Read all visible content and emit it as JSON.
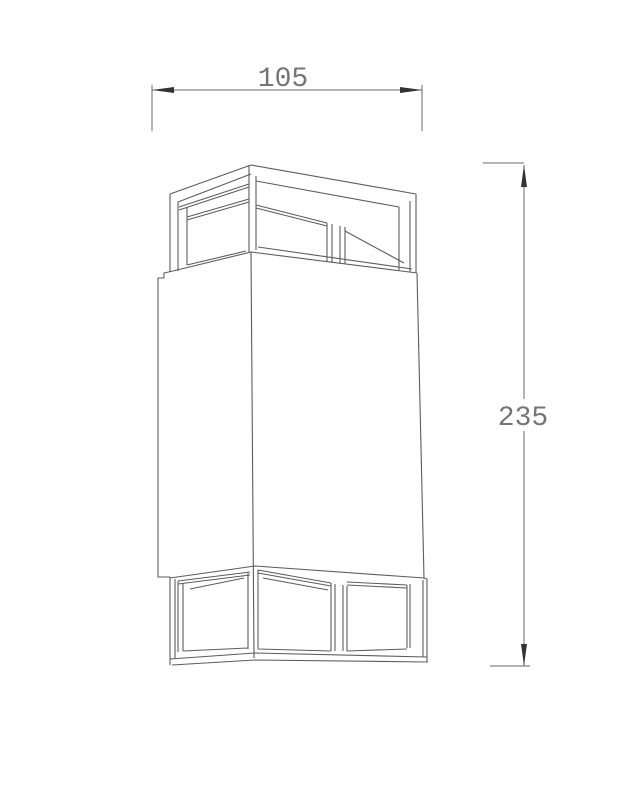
{
  "dimensions": {
    "width": {
      "value": "105"
    },
    "height": {
      "value": "235"
    }
  },
  "drawing": {
    "subject": "wall-light-fixture-line-drawing",
    "views": [
      "perspective"
    ]
  },
  "colors": {
    "background": "#ffffff",
    "line": "#5c5c5c",
    "dimension_line": "#6a6a6a",
    "dimension_text": "#757575",
    "arrow": "#333333"
  }
}
